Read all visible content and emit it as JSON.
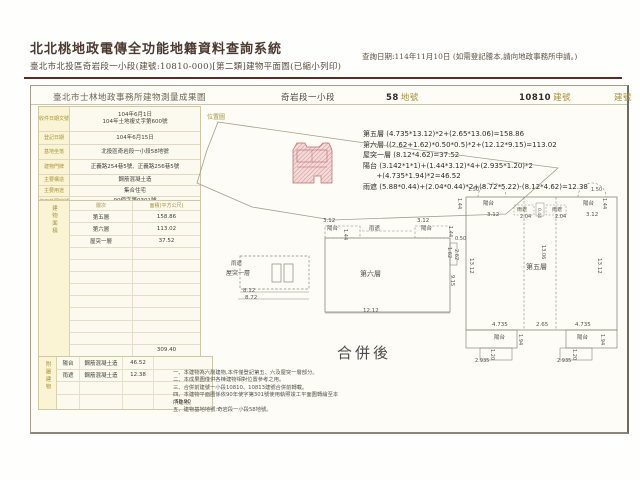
{
  "header": {
    "system_title": "北北桃地政電傳全功能地籍資料查詢系統",
    "doc_subtitle": "臺北市北投區奇岩段一小段(建號:10810-000)[第二類]建物平面圖(已縮小列印)",
    "query_date": "查詢日期:114年11月10日 (如需登記謄本,請向地政事務所申請。)"
  },
  "form": {
    "title": "臺北市士林地政事務所建物測量成果圖",
    "section": "奇岩段一小段",
    "land_number": "58",
    "land_label": "地號",
    "building_number": "10810",
    "building_label": "建號",
    "building_label_right": "建號",
    "site_plan_label": "位置圖",
    "merge_label": "合併後",
    "info_rows": [
      {
        "label": "收件日期文號",
        "value": "104年6月1日\n104年土地複丈字第600號"
      },
      {
        "label": "登記日期",
        "value": "104年6月15日"
      },
      {
        "label": "基地坐落",
        "value": "北投區奇岩段一小段58地號"
      },
      {
        "label": "建物門牌",
        "value": "正義路254巷5號、正義路256巷5號"
      },
      {
        "label": "主要構造",
        "value": "鋼筋混凝土造"
      },
      {
        "label": "主要用途",
        "value": "集合住宅"
      },
      {
        "label": "使用執照字號",
        "value": "90使字第0301號"
      }
    ],
    "area_table": {
      "side_label": "建物面積",
      "header_floor": "層次",
      "header_area": "面積(平方公尺)",
      "rows": [
        {
          "floor": "第五層",
          "area": "158.86"
        },
        {
          "floor": "第六層",
          "area": "113.02"
        },
        {
          "floor": "屋突一層",
          "area": "37.52"
        }
      ],
      "total": "309.40"
    },
    "annex_table": {
      "side_label": "附屬建物",
      "rows": [
        {
          "name": "陽台",
          "structure": "鋼筋混凝土造",
          "area": "46.52"
        },
        {
          "name": "雨遮",
          "structure": "鋼筋混凝土造",
          "area": "12.38"
        }
      ],
      "total": "58.90"
    },
    "formulas": [
      "第五層 (4.735*13.12)*2+(2.65*13.06)=158.86",
      "第六層 ((2.62+1.62)*0.50*0.5)*2+(12.12*9.15)=113.02",
      "屋突一層 (8.12*4.62)=37.52",
      "陽台 (3.142*1*1)+(1.44*3.12)*4+(2.935*1.20)*2",
      "      +(4.735*1.94)*2=46.52",
      "雨遮 (5.88*0.44)+(2.04*0.44)*2+(8.72*5.22)-(8.12*4.62)=12.38"
    ],
    "notes": [
      "一、本建物為六層建物,本件僅登記第五、六及屋突一層部分。",
      "二、本成果圖僅供各棟建物相對位置參考之用。",
      "三、合併前建號一小段10810、10813建號合併前轉載。",
      "四、本建物平面圖係依90年使字第301號使用執照竣工平面圖轉繪至本所建物。",
      "五、建物基地地號:奇岩段一小段58地號。"
    ],
    "plan_labels": [
      {
        "t": "雨遮",
        "x": 231,
        "y": 262,
        "s": 5.5
      },
      {
        "t": "屋突一層",
        "x": 226,
        "y": 271,
        "s": 6
      },
      {
        "t": "8.12",
        "x": 243,
        "y": 289,
        "s": 5.5
      },
      {
        "t": "8.72",
        "x": 245,
        "y": 296,
        "s": 5.5
      },
      {
        "t": "3.12",
        "x": 323,
        "y": 219,
        "s": 5.5
      },
      {
        "t": "陽台",
        "x": 327,
        "y": 227,
        "s": 5.5
      },
      {
        "t": "1.44",
        "x": 347,
        "y": 229,
        "s": 5,
        "r": 90
      },
      {
        "t": "雨遮",
        "x": 369,
        "y": 227,
        "s": 5.5
      },
      {
        "t": "3.12",
        "x": 417,
        "y": 219,
        "s": 5.5
      },
      {
        "t": "陽台",
        "x": 421,
        "y": 227,
        "s": 5.5
      },
      {
        "t": "1.44",
        "x": 452,
        "y": 226,
        "s": 5,
        "r": 90
      },
      {
        "t": "0.50",
        "x": 455,
        "y": 237,
        "s": 5
      },
      {
        "t": "1.62",
        "x": 451,
        "y": 247,
        "s": 5,
        "r": 90
      },
      {
        "t": "2.62",
        "x": 458,
        "y": 249,
        "s": 5,
        "r": 90
      },
      {
        "t": "9.15",
        "x": 454,
        "y": 275,
        "s": 5,
        "r": 90
      },
      {
        "t": "第六層",
        "x": 360,
        "y": 271,
        "s": 7
      },
      {
        "t": "12.12",
        "x": 363,
        "y": 309,
        "s": 5.5
      },
      {
        "t": "1.50",
        "x": 468,
        "y": 188,
        "s": 5
      },
      {
        "t": "1.44",
        "x": 461,
        "y": 198,
        "s": 5,
        "r": 90
      },
      {
        "t": "陽台",
        "x": 483,
        "y": 202,
        "s": 5.5
      },
      {
        "t": "3.12",
        "x": 487,
        "y": 213,
        "s": 5.5
      },
      {
        "t": "雨遮",
        "x": 517,
        "y": 208,
        "s": 5
      },
      {
        "t": "2.04",
        "x": 520,
        "y": 215,
        "s": 5
      },
      {
        "t": "0.44",
        "x": 540,
        "y": 208,
        "s": 4.5,
        "r": 90
      },
      {
        "t": "雨遮",
        "x": 552,
        "y": 208,
        "s": 5
      },
      {
        "t": "2.04",
        "x": 555,
        "y": 215,
        "s": 5
      },
      {
        "t": "陽台",
        "x": 583,
        "y": 202,
        "s": 5.5
      },
      {
        "t": "1.50",
        "x": 591,
        "y": 188,
        "s": 5
      },
      {
        "t": "1.44",
        "x": 606,
        "y": 198,
        "s": 5,
        "r": 90
      },
      {
        "t": "3.12",
        "x": 586,
        "y": 213,
        "s": 5.5
      },
      {
        "t": "13.12",
        "x": 473,
        "y": 258,
        "s": 5.5,
        "r": 90
      },
      {
        "t": "13.06",
        "x": 545,
        "y": 245,
        "s": 5,
        "r": 90
      },
      {
        "t": "第五層",
        "x": 526,
        "y": 264,
        "s": 7
      },
      {
        "t": "13.12",
        "x": 601,
        "y": 258,
        "s": 5.5,
        "r": 90
      },
      {
        "t": "4.735",
        "x": 492,
        "y": 323,
        "s": 5.5
      },
      {
        "t": "2.65",
        "x": 536,
        "y": 323,
        "s": 5.5
      },
      {
        "t": "4.735",
        "x": 575,
        "y": 323,
        "s": 5.5
      },
      {
        "t": "陽台",
        "x": 494,
        "y": 336,
        "s": 5.5
      },
      {
        "t": "1.94",
        "x": 522,
        "y": 334,
        "s": 5,
        "r": 90
      },
      {
        "t": "陽台",
        "x": 577,
        "y": 336,
        "s": 5.5
      },
      {
        "t": "1.94",
        "x": 604,
        "y": 334,
        "s": 5,
        "r": 90
      },
      {
        "t": "2.935",
        "x": 475,
        "y": 359,
        "s": 5
      },
      {
        "t": "1.20",
        "x": 494,
        "y": 349,
        "s": 5,
        "r": 90
      },
      {
        "t": "2.935",
        "x": 557,
        "y": 359,
        "s": 5
      },
      {
        "t": "1.20",
        "x": 576,
        "y": 349,
        "s": 5,
        "r": 90
      }
    ]
  }
}
